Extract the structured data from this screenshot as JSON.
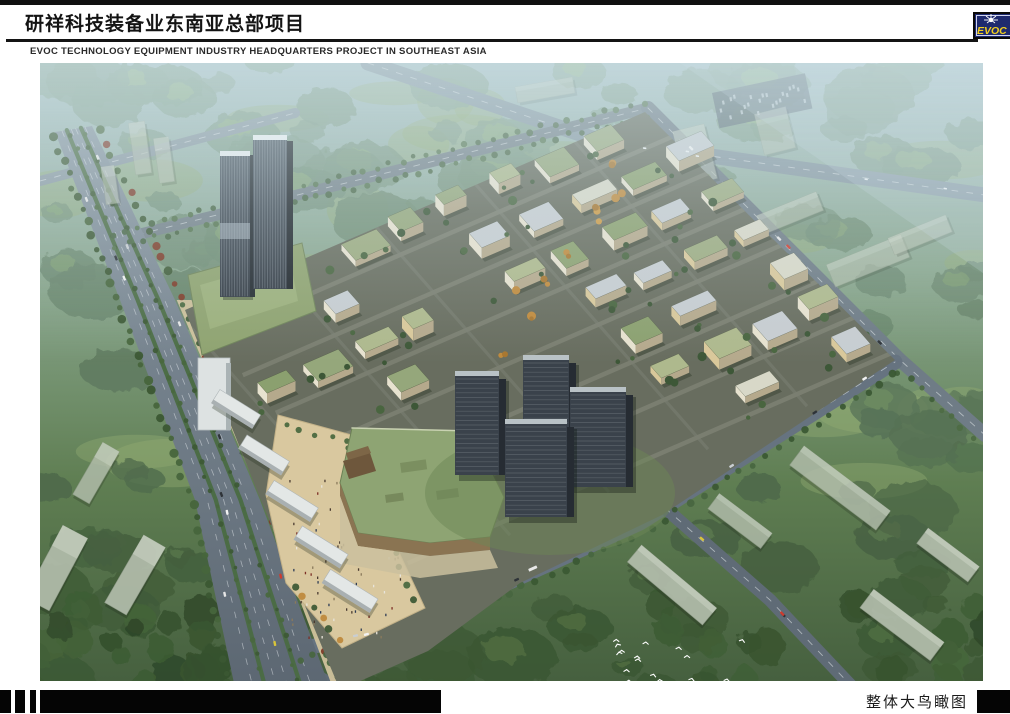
{
  "header": {
    "title_cn": "研祥科技装备业东南亚总部项目",
    "title_en": "EVOC TECHNOLOGY EQUIPMENT INDUSTRY HEADQUARTERS PROJECT IN SOUTHEAST ASIA",
    "logo": {
      "text": "EVOC"
    }
  },
  "footer": {
    "caption": "整体大鸟瞰图"
  },
  "colors": {
    "logo_navy": "#1e2a6e",
    "logo_yellow": "#f2cf1d",
    "rule_black": "#141414",
    "haze_blue": "#a9c2c6",
    "roof_green": "#93a474",
    "road_gray": "#6b7883",
    "plaza_sand": "#d9c89f",
    "tower_dark": "#3a424b"
  }
}
